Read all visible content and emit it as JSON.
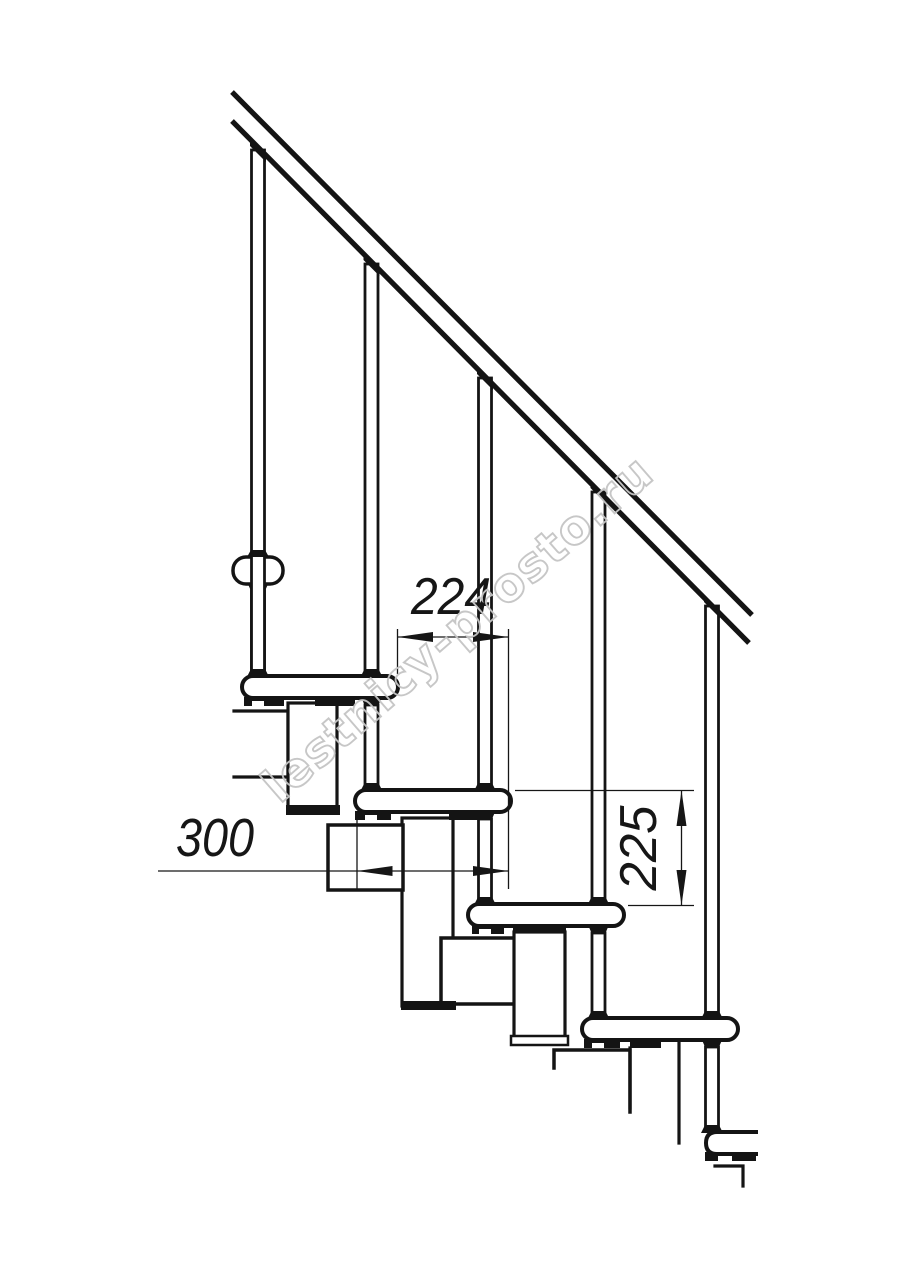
{
  "drawing": {
    "dims": {
      "step_run": "224",
      "tread_depth": "300",
      "step_rise": "225"
    },
    "watermark_text": "lestnicy-prosto.ru",
    "colors": {
      "ink": "#141414",
      "watermark": "#c5c5c5",
      "background": "#ffffff"
    }
  }
}
